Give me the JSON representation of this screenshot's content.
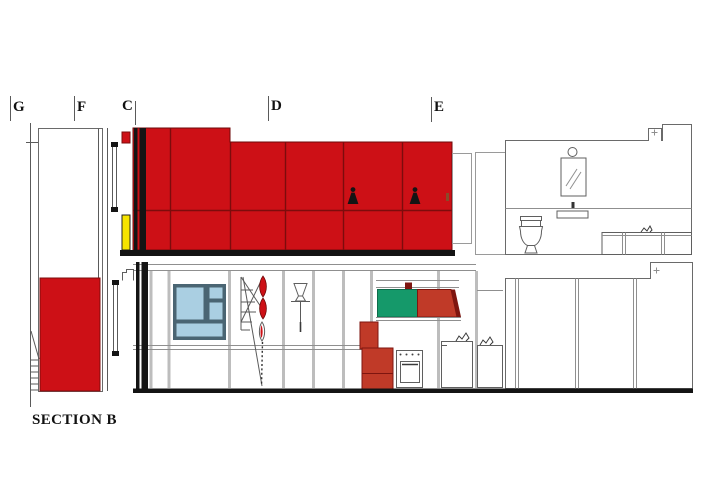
{
  "title": {
    "label": "SECTION B"
  },
  "grid_labels": [
    {
      "id": "G",
      "label": "G"
    },
    {
      "id": "F",
      "label": "F"
    },
    {
      "id": "C",
      "label": "C"
    },
    {
      "id": "D",
      "label": "D"
    },
    {
      "id": "E",
      "label": "E"
    }
  ],
  "drawing": {
    "kind": "architectural section elevation",
    "floors": 2,
    "figure_count": 2
  },
  "colors": {
    "red": "#cd1016",
    "red_seam": "#7d0c0c",
    "yellow": "#f6e400",
    "green": "#15996a",
    "brick": "#c03a28",
    "brick_dark": "#7e150f",
    "pane_blue": "#aacfe2",
    "frame_blue": "#4a6573",
    "black": "#141414"
  }
}
